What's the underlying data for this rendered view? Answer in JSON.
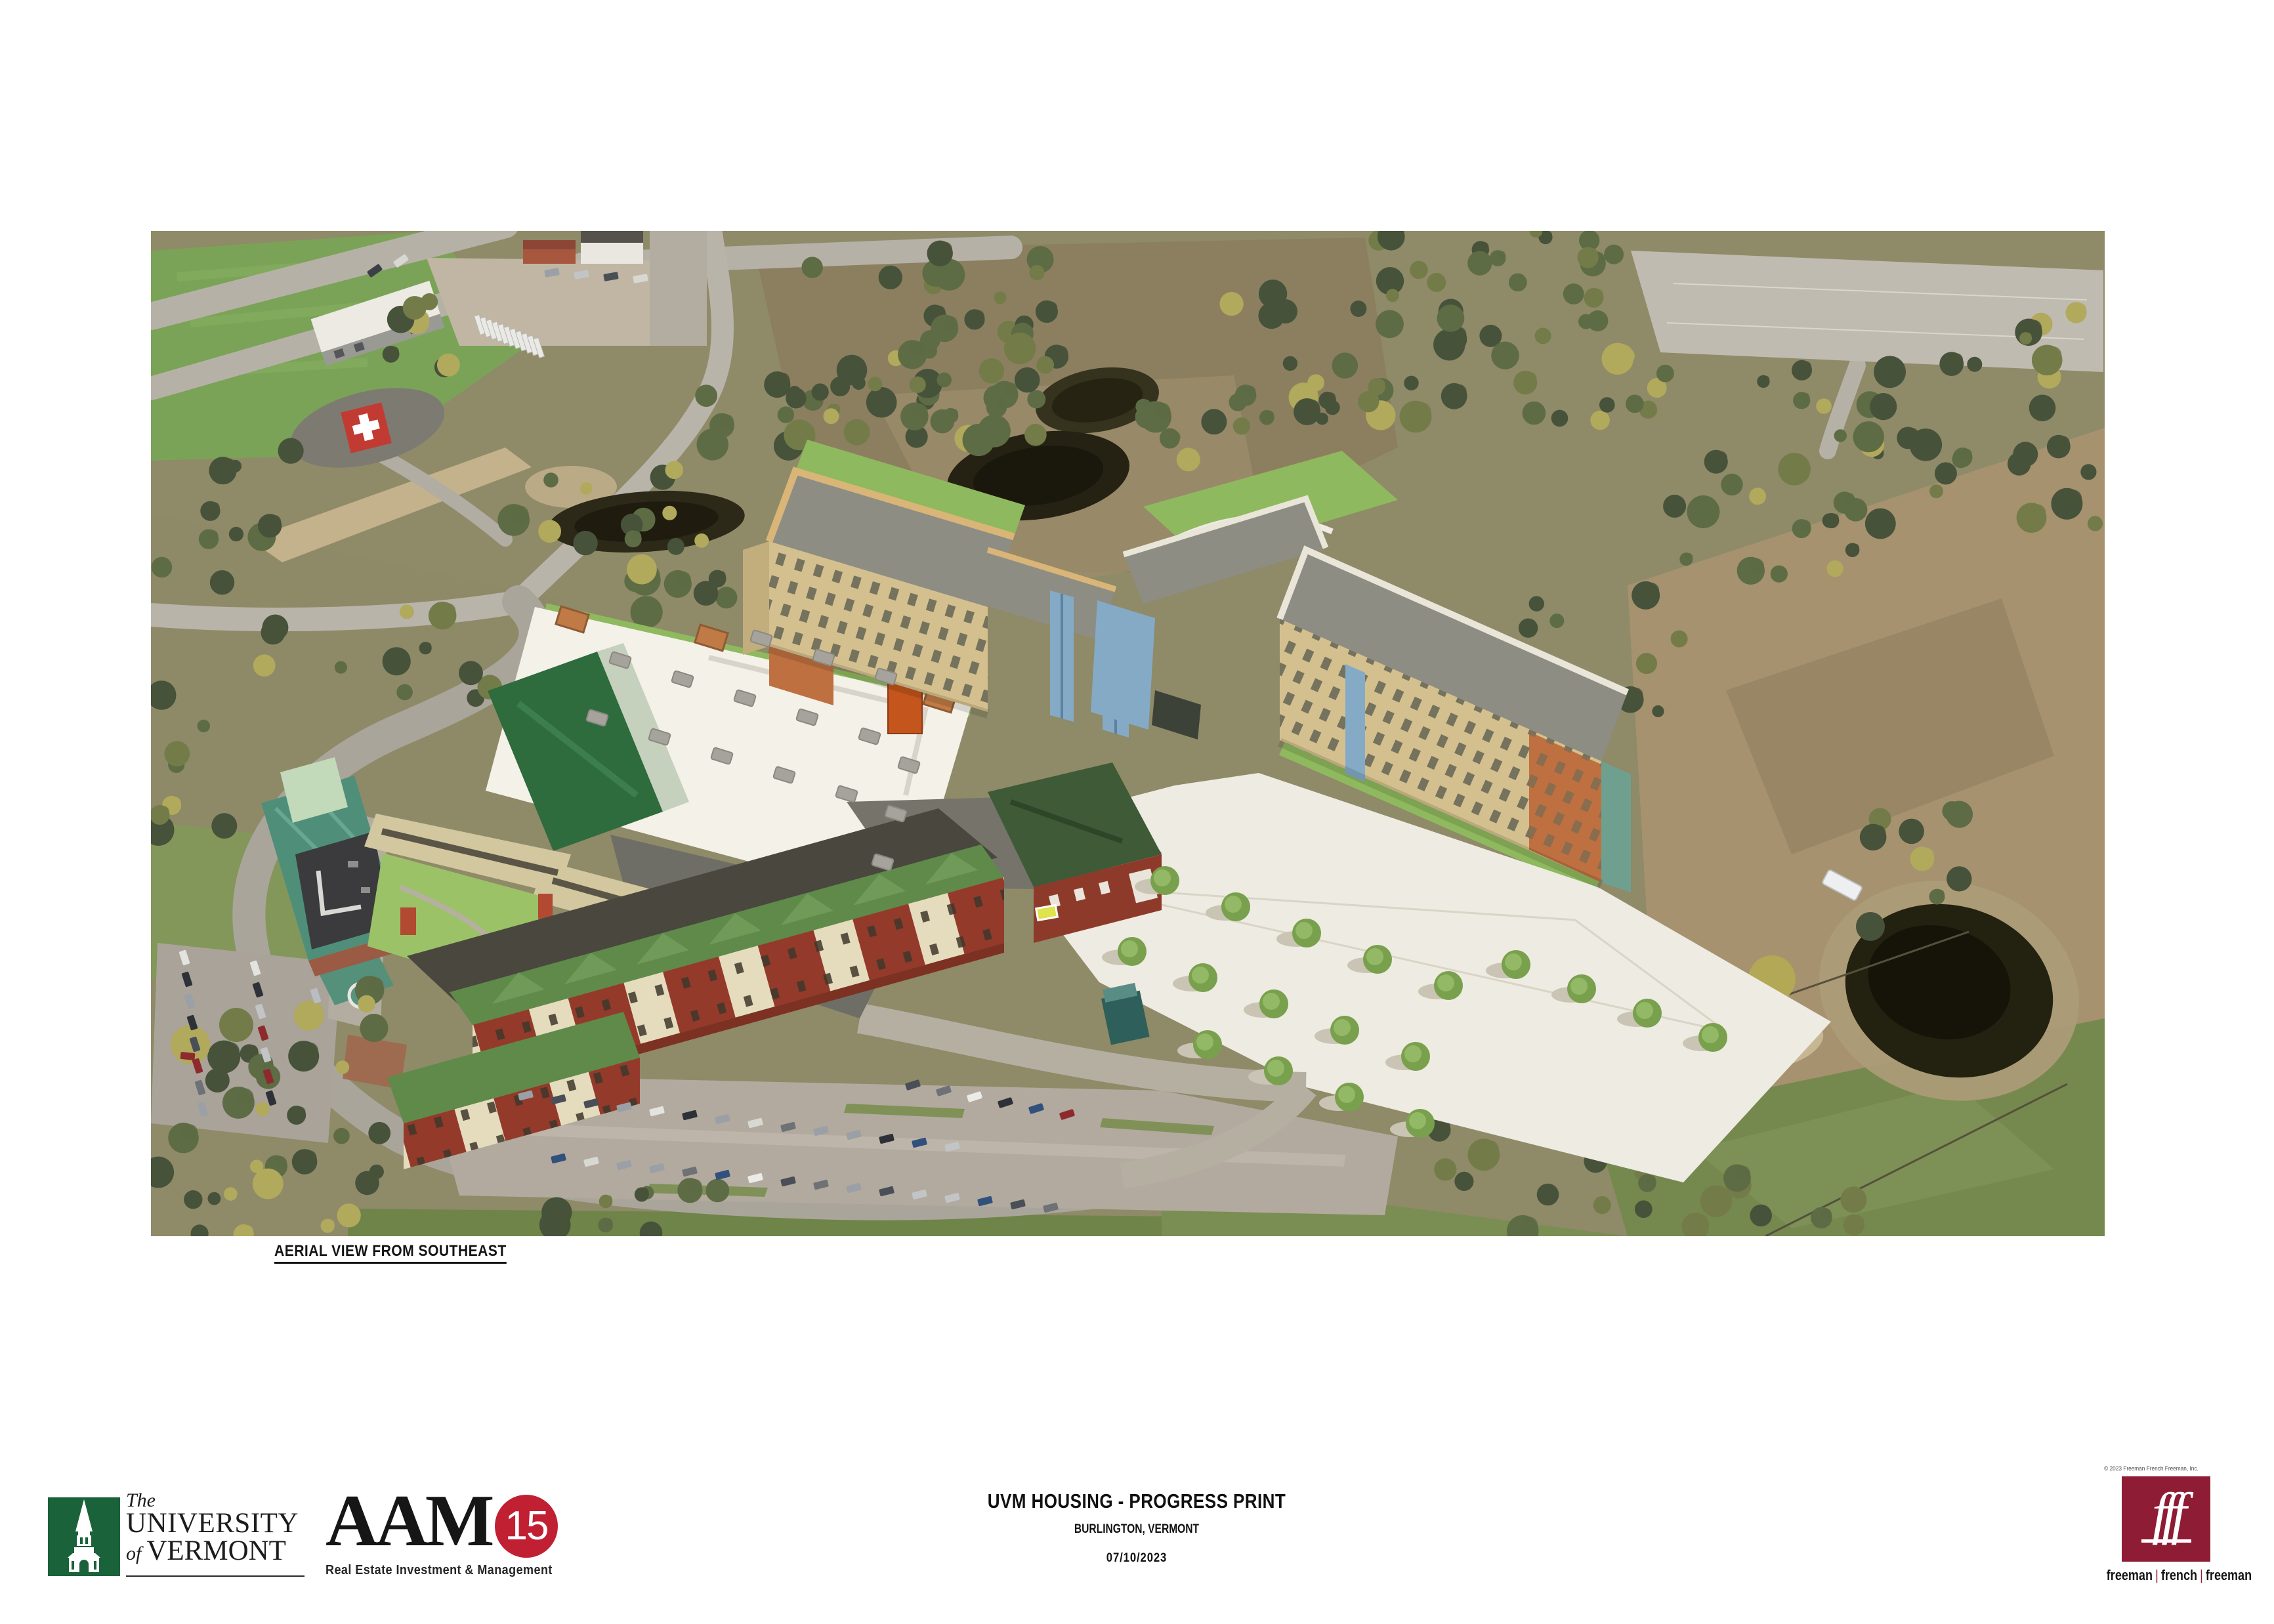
{
  "caption": "AERIAL VIEW FROM SOUTHEAST",
  "title_block": {
    "title": "UVM HOUSING - PROGRESS PRINT",
    "location": "BURLINGTON, VERMONT",
    "date": "07/10/2023"
  },
  "logos": {
    "uvm": {
      "word_the": "The",
      "word_university": "UNIVERSITY",
      "word_of": "of",
      "word_vermont": "VERMONT",
      "green": "#1a6239"
    },
    "aam15": {
      "name": "AAM",
      "badge": "15",
      "badge_color": "#c12032",
      "tagline": "Real Estate Investment & Management"
    },
    "fff": {
      "copyright": "© 2023 Freeman French Freeman, Inc.",
      "monogram": "fff",
      "square_color": "#8e1c34",
      "wordmark": [
        "freeman",
        "french",
        "freeman"
      ]
    }
  },
  "aerial_view": {
    "description": "Aerial rendering from southeast of proposed UVM housing: new tan dormitory bars with gray roofs and glass connectors, white podium roof, red-brick senior housing with green gable roofs, rendered white parking plaza with street trees, set into aerial photo of fields, roads, ponds, woods and existing hospital buildings",
    "palette": {
      "field_green": "#7ba357",
      "render_lawn": "#8fb95e",
      "dorm_tan": "#d4c08f",
      "dorm_roof_gray": "#8d8d84",
      "parapet_buff": "#d9b577",
      "glass_blue": "#85aac6",
      "brick_orange": "#bf7040",
      "brick_red": "#943a2b",
      "gable_green": "#5f8a4a",
      "teal_roof": "#4f8f7a",
      "plaza_white": "#eeebe2",
      "pond_dark": "#23210f",
      "road_gray": "#b6b1a7",
      "scrub_brown": "#8f8a68"
    }
  }
}
